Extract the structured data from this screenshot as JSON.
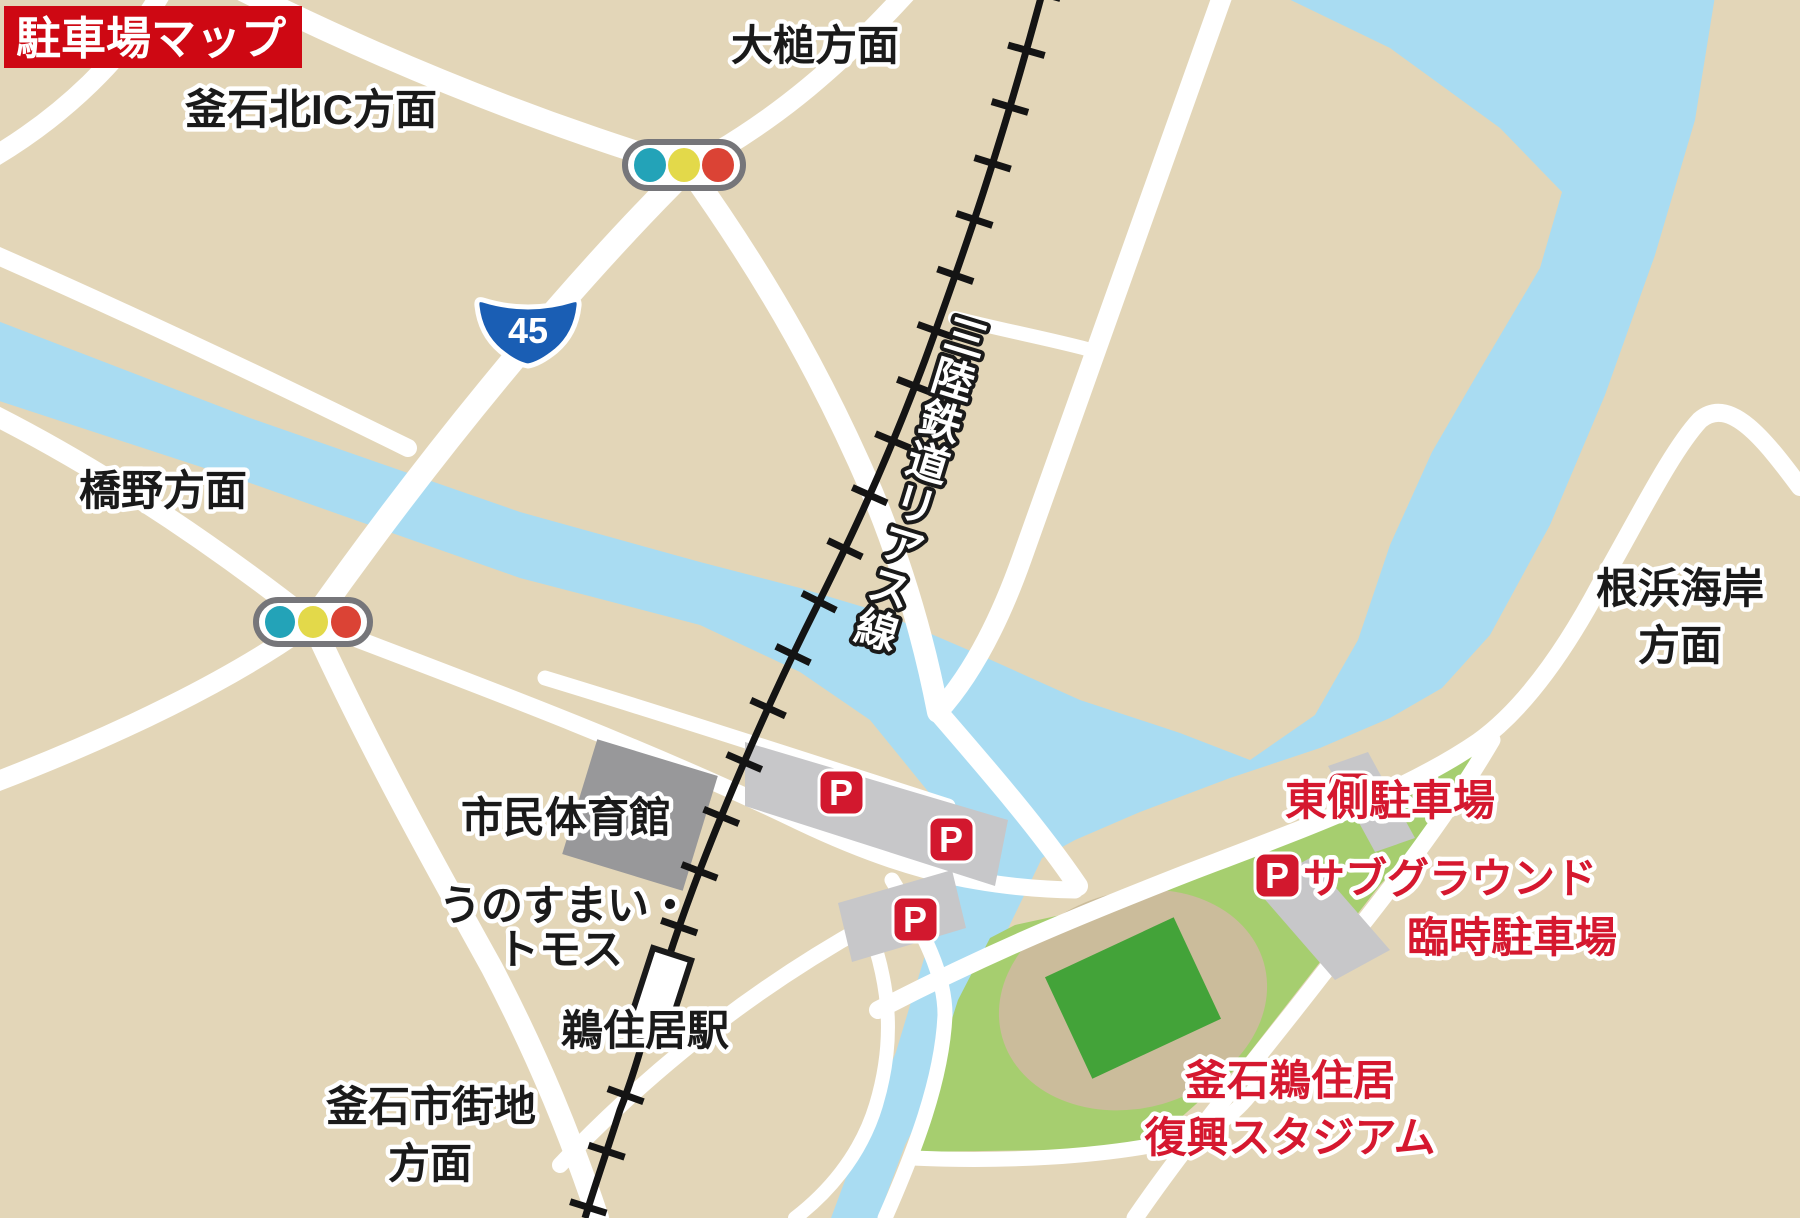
{
  "banner": {
    "title": "駐車場マップ"
  },
  "directions": {
    "kamaishi_kita_ic": "釜石北IC方面",
    "otsuchi": "大槌方面",
    "hashino": "橋野方面",
    "nebama_line1": "根浜海岸",
    "nebama_line2": "方面",
    "kamaishi_city_line1": "釜石市街地",
    "kamaishi_city_line2": "方面"
  },
  "railway": {
    "line_name": "三陸鉄道リアス線",
    "station_name": "鵜住居駅"
  },
  "route_shield": {
    "number": "45"
  },
  "landmarks": {
    "gymnasium": "市民体育館",
    "tomosu_line1": "うのすまい・",
    "tomosu_line2": "トモス"
  },
  "stadium": {
    "name_line1": "釜石鵜住居",
    "name_line2": "復興スタジアム"
  },
  "parking": {
    "p_symbol": "P",
    "east_lot_label": "東側駐車場",
    "subground_line1": "サブグラウンド",
    "subground_line2": "臨時駐車場"
  },
  "colors": {
    "land": "#e3d6b8",
    "water": "#a9dcf2",
    "road": "#ffffff",
    "railway": "#141414",
    "park_green": "#a6ce6f",
    "stadium_stands": "#cbbc9b",
    "stadium_field": "#43a339",
    "parking_gray": "#c7c7c9",
    "building_gray": "#98989a",
    "banner_red": "#ce0813",
    "label_red": "#d5182f",
    "p_icon_red": "#d2182e",
    "shield_blue": "#1a5eb4",
    "signal_teal": "#23a3b8",
    "signal_yellow": "#e3d94a",
    "signal_red": "#db4335"
  }
}
